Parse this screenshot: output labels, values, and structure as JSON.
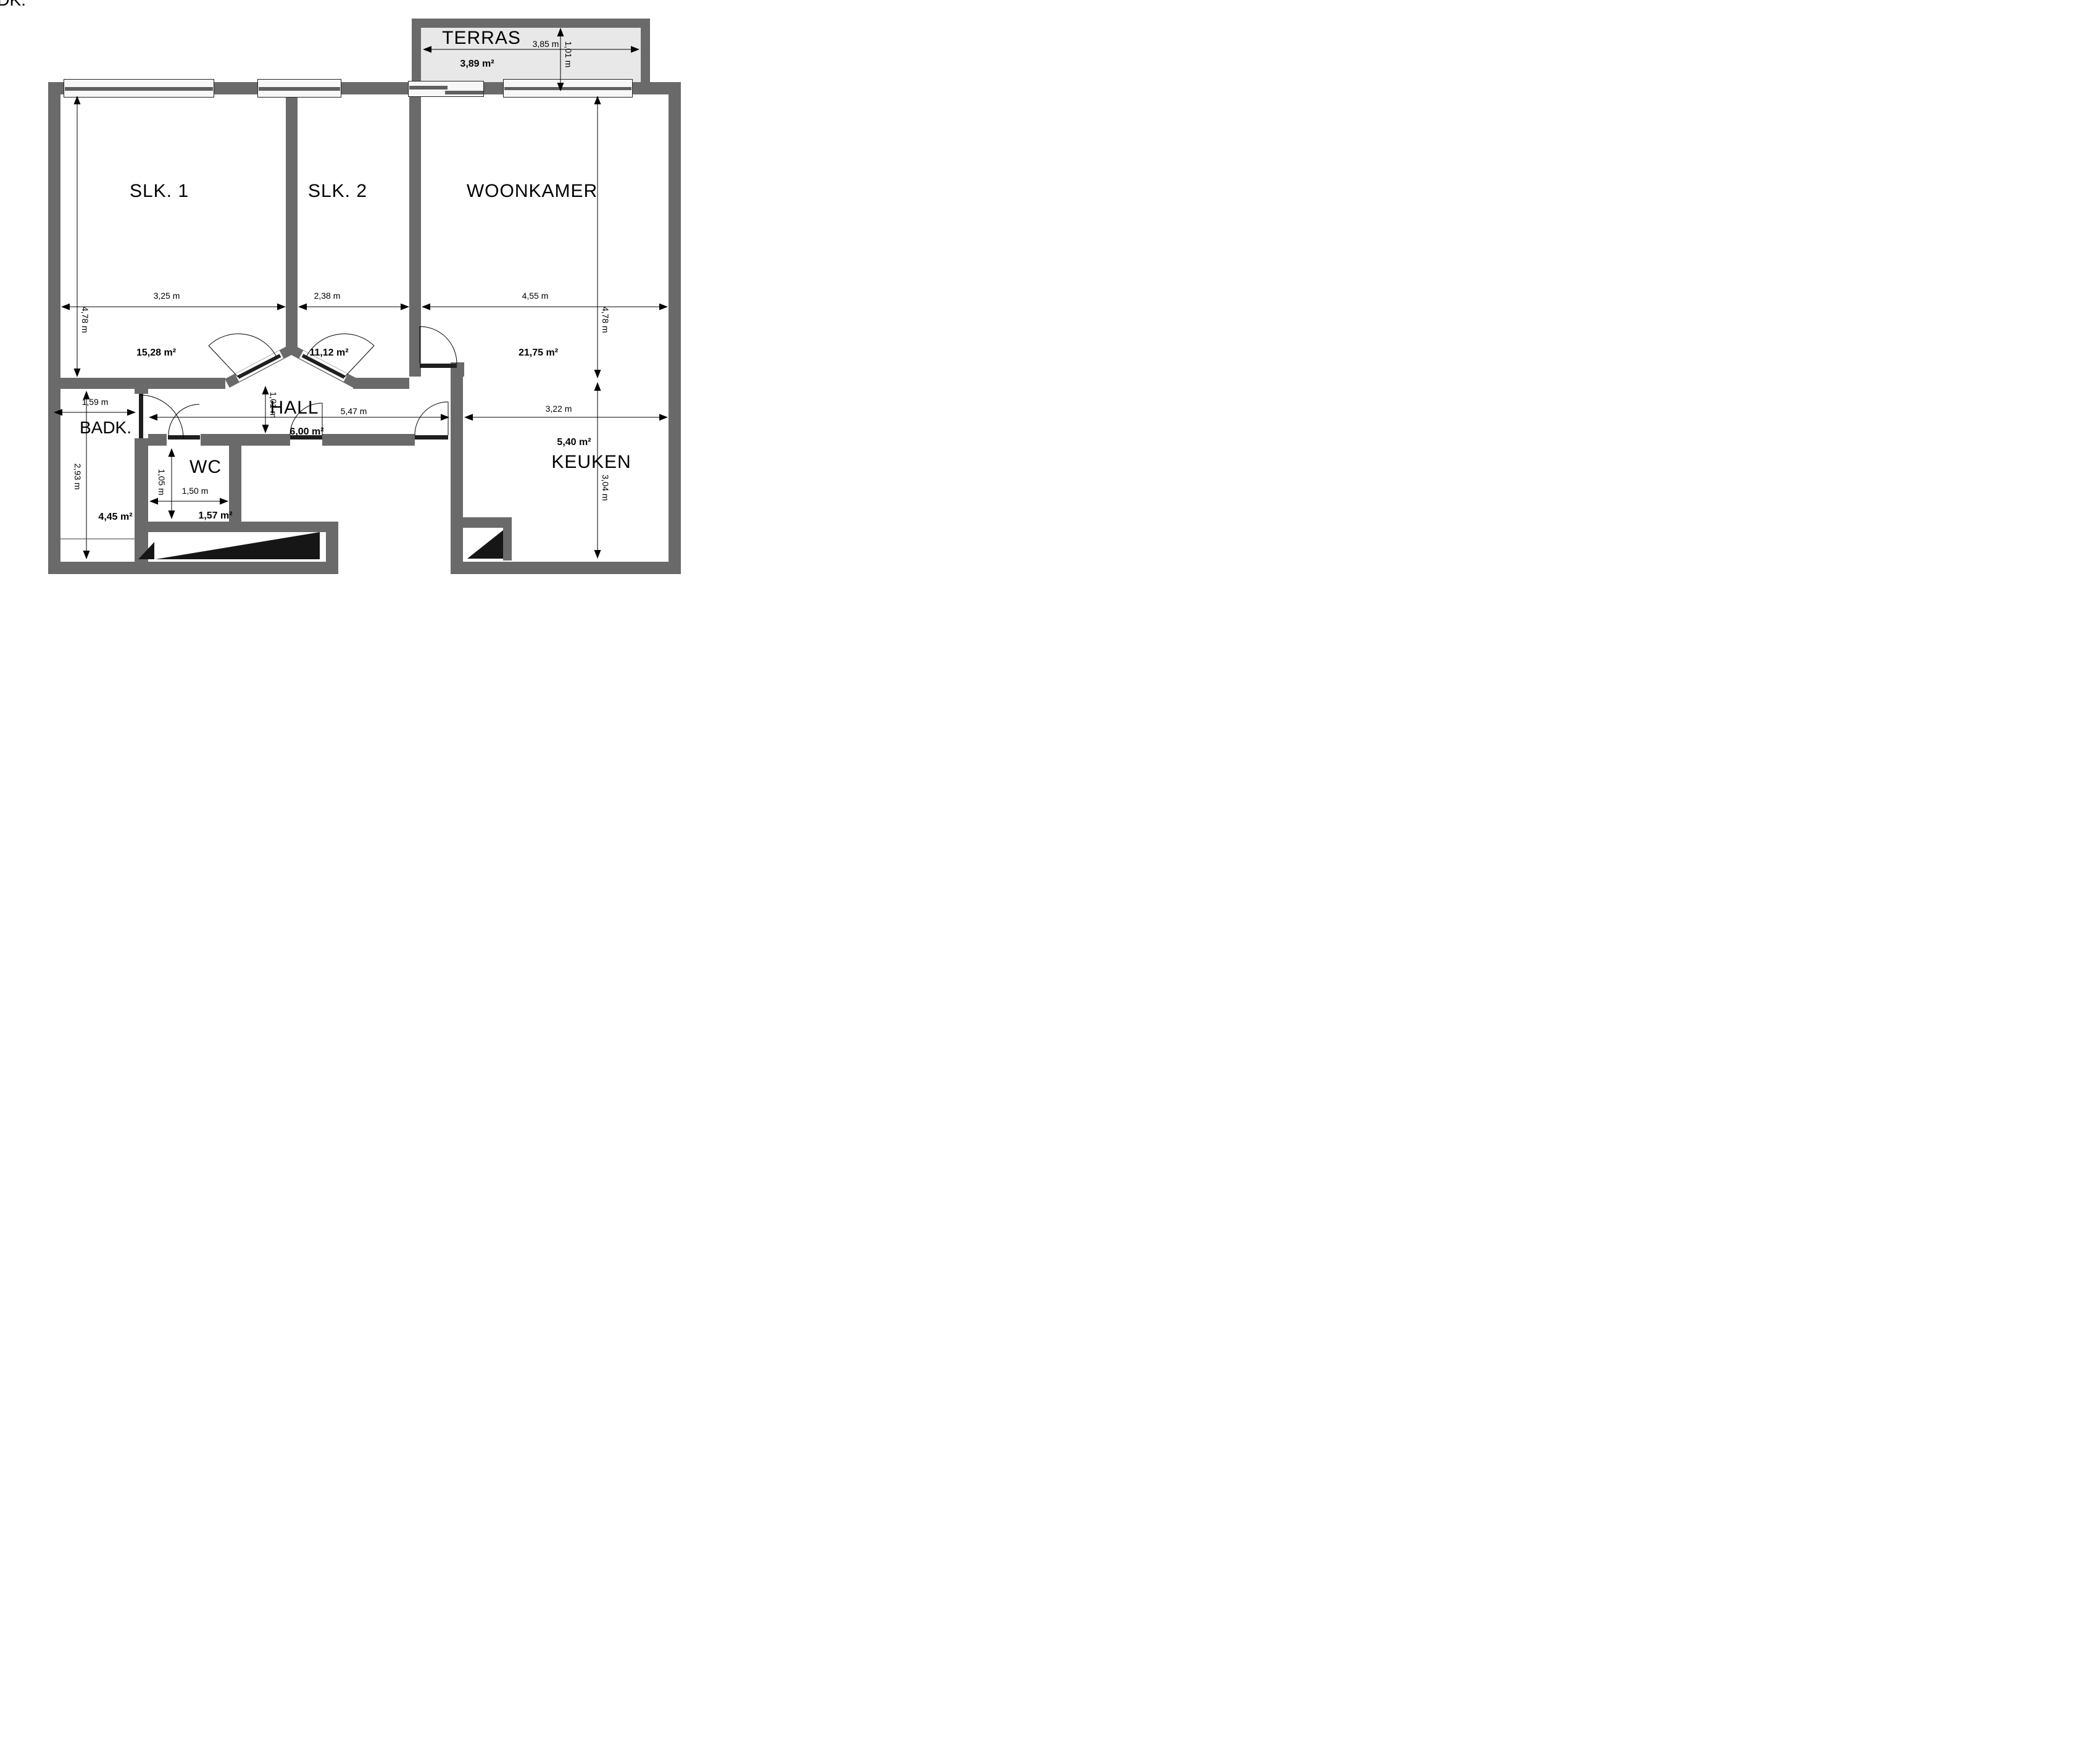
{
  "plan_title": "Floor plan",
  "colors": {
    "wall": "#6a6a6a",
    "terrace_floor": "#e8e8e8",
    "door_leaf": "#1f1f1f",
    "shaft_triangle": "#161616",
    "dimension_line": "#000000"
  },
  "rooms": {
    "terras": {
      "name": "TERRAS",
      "width_label": "3,85 m",
      "depth_label": "1,01 m",
      "area_label": "3,89 m²"
    },
    "slk1": {
      "name": "SLK. 1",
      "width_label": "3,25 m",
      "height_label": "4,78 m",
      "area_label": "15,28 m²"
    },
    "slk2": {
      "name": "SLK. 2",
      "width_label": "2,38 m",
      "area_label": "11,12 m²"
    },
    "woonkamer": {
      "name": "WOONKAMER",
      "width_label": "4,55 m",
      "height_label": "4,78 m",
      "area_label": "21,75 m²"
    },
    "hall": {
      "name": "HALL",
      "width_label": "5,47 m",
      "height_label": "1,01 m",
      "area_label": "6,00 m²"
    },
    "badk": {
      "name": "BADK.",
      "width_label": "1,59 m",
      "height_label": "2,93 m",
      "area_label": "4,45 m²"
    },
    "wc": {
      "name": "WC",
      "width_label": "1,50 m",
      "height_label": "1,05 m",
      "area_label": "1,57 m²"
    },
    "keuken": {
      "name": "KEUKEN",
      "width_label": "3,22 m",
      "height_label": "3,04 m",
      "area_label": "5,40 m²"
    }
  }
}
